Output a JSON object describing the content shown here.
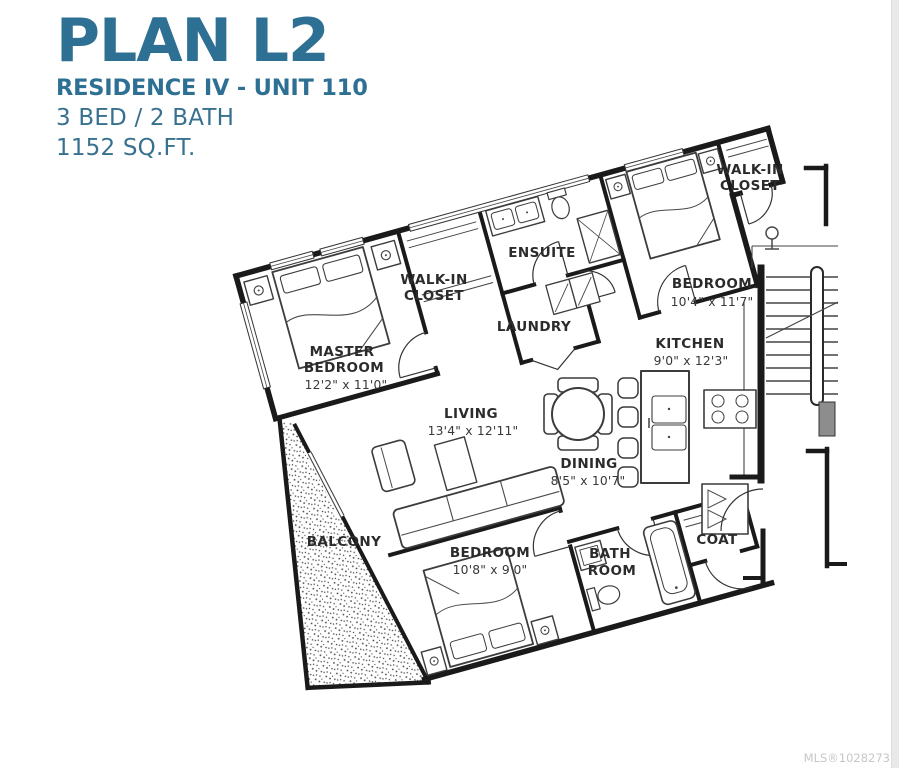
{
  "title": {
    "plan": "PLAN L2",
    "residence": "RESIDENCE IV - UNIT 110",
    "beds_baths": "3 BED / 2 BATH",
    "area": "1152 SQ.FT."
  },
  "rooms": {
    "master_bedroom": {
      "name_line1": "MASTER",
      "name_line2": "BEDROOM",
      "dims": "12'2\" x 11'0\""
    },
    "walk_in_closet_master": {
      "name_line1": "WALK-IN",
      "name_line2": "CLOSET"
    },
    "ensuite": {
      "name": "ENSUITE"
    },
    "laundry": {
      "name": "LAUNDRY"
    },
    "bedroom2": {
      "name": "BEDROOM",
      "dims": "10'4\" x 11'7\""
    },
    "walk_in_closet2": {
      "name_line1": "WALK-IN",
      "name_line2": "CLOSET"
    },
    "kitchen": {
      "name": "KITCHEN",
      "dims": "9'0\" x 12'3\""
    },
    "living": {
      "name": "LIVING",
      "dims": "13'4\" x 12'11\""
    },
    "dining": {
      "name": "DINING",
      "dims": "8'5\" x 10'7\""
    },
    "balcony": {
      "name": "BALCONY"
    },
    "bedroom3": {
      "name": "BEDROOM",
      "dims": "10'8\" x 9'0\""
    },
    "bathroom": {
      "name_line1": "BATH",
      "name_line2": "ROOM"
    },
    "coat": {
      "name": "COAT"
    }
  },
  "footer": {
    "mls": "MLS®1028273"
  },
  "colors": {
    "accent": "#2e7093",
    "accent_light": "#37718f",
    "wall": "#1a1a1a",
    "mls_gray": "#c6c6c6"
  }
}
